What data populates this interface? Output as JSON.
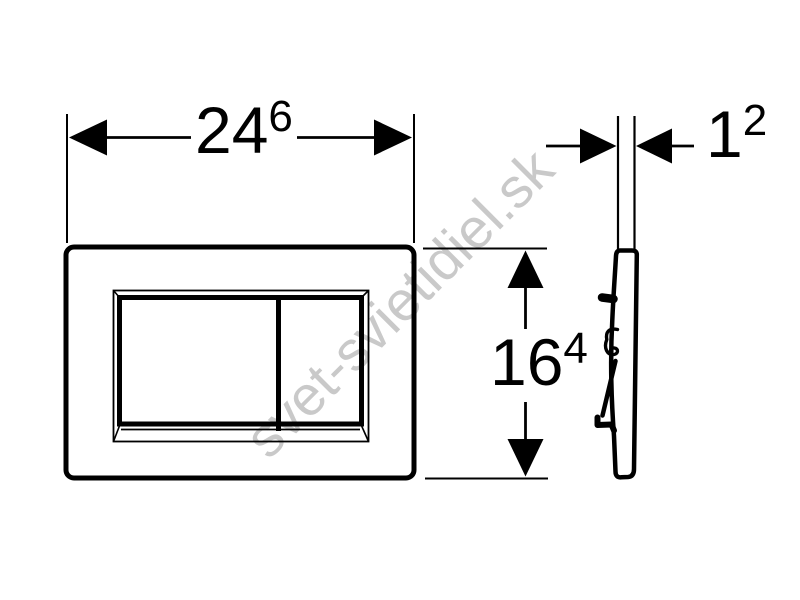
{
  "drawing": {
    "background_color": "#ffffff",
    "line_color": "#000000"
  },
  "watermark": {
    "text": "svet-svietidiel.sk",
    "color": "#c9c9c9"
  },
  "dimensions": {
    "width": {
      "value": "24",
      "superscript": "6"
    },
    "height": {
      "value": "16",
      "superscript": "4"
    },
    "thickness": {
      "value": "1",
      "superscript": "2"
    }
  }
}
